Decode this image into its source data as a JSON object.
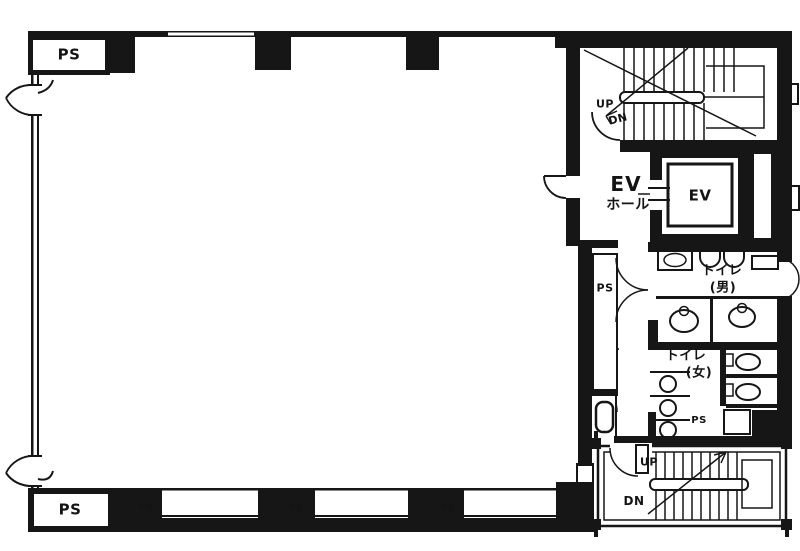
{
  "colors": {
    "wall": "#161616",
    "background": "#ffffff"
  },
  "labels": {
    "pipe_shaft": "PS",
    "up": "UP",
    "down": "DN",
    "elevator_hall_line1": "EV",
    "elevator_hall_line2": "ホール",
    "elevator_car": "EV",
    "toilet_men_line1": "トイレ",
    "toilet_men_line2": "(男)",
    "toilet_women_line1": "トイレ",
    "toilet_women_line2": "(女)"
  }
}
